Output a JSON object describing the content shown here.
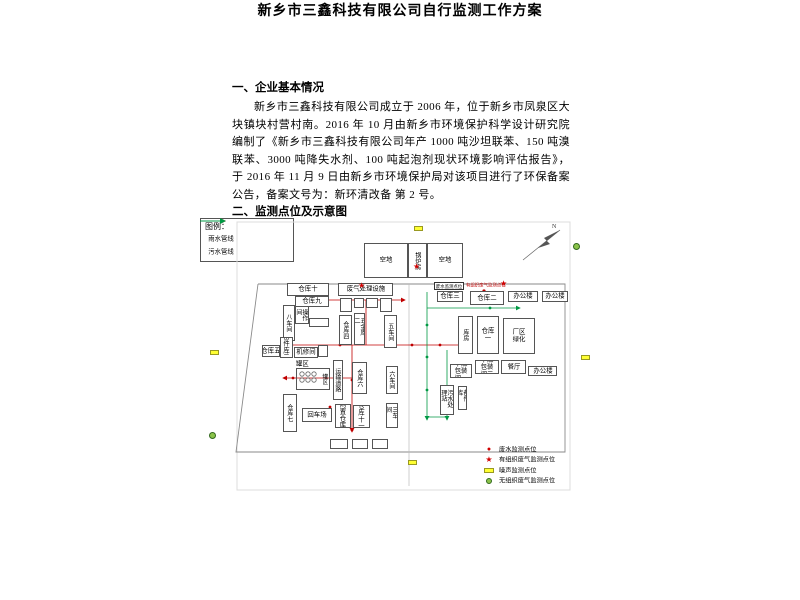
{
  "doc": {
    "title": "新乡市三鑫科技有限公司自行监测工作方案",
    "section1_heading": "一、企业基本情况",
    "paragraph": "新乡市三鑫科技有限公司成立于 2006 年，位于新乡市凤泉区大块镇块村营村南。2016 年 10 月由新乡市环境保护科学设计研究院编制了《新乡市三鑫科技有限公司年产 1000 吨沙坦联苯、150 吨溴联苯、3000 吨降失水剂、100 吨起泡剂现状环境影响评估报告》，于 2016 年 11 月 9 日由新乡市环境保护局对该项目进行了环保备案公告，备案文号为：新环清改备 第 2 号。",
    "section2_heading": "二、监测点位及示意图"
  },
  "diagram": {
    "legend": {
      "title": "图例：",
      "rain": "雨水管线",
      "sewage": "污水管线"
    },
    "compass_label": "N",
    "tags": {
      "wastewater": "废水监测点位",
      "organized_gas": "有组织废气监测点位"
    },
    "buildings": {
      "kongdi1": "空地",
      "guolufang": "锅炉房",
      "kongdi2": "空地",
      "cangku10": "仓库十",
      "cangku9": "仓库九",
      "feiqi": "废气处理设施",
      "cangku3": "仓库三",
      "cangku2": "仓库二",
      "bangonglou1": "办公楼",
      "bangonglou2": "办公楼",
      "bachejian": "八车间",
      "caozuojian": "操作间",
      "beijianku2": "备件库二",
      "cangku5": "仓库五",
      "jixiujian": "机修间",
      "cangku4": "仓库四",
      "wujinku2": "五金库二",
      "wuchejian": "五车间",
      "kufang": "库房",
      "cangku1": "仓库一",
      "changqulvhua": "厂区绿化",
      "ganzao1": "干燥包装间一",
      "ganzao2": "干燥包装间二",
      "canting": "餐厅",
      "bangonglou3": "办公楼",
      "wushuichuli": "污水处理站",
      "beijianku": "备件库",
      "guanqu": "罐区",
      "yunshudaolu": "运输道路",
      "cangku6": "仓库六",
      "liuchejian": "六车间",
      "sanchejian": "三车间",
      "cangku7": "仓库七",
      "huichechang": "回车场",
      "xianzhicangku": "闲置仓库",
      "cangku11": "仓库十一"
    },
    "point_legend": {
      "wastewater": "废水监测点位",
      "organized_gas": "有组织废气监测点位",
      "noise": "噪声监测点位",
      "fugitive_gas": "无组织废气监测点位"
    },
    "icons": {
      "dot": "●",
      "star": "★"
    },
    "colors": {
      "rain_line": "#c00000",
      "sewage_line": "#009944",
      "noise_marker": "#ffff33",
      "fugitive_marker": "#8bc34a",
      "star_marker": "#d00000"
    }
  }
}
